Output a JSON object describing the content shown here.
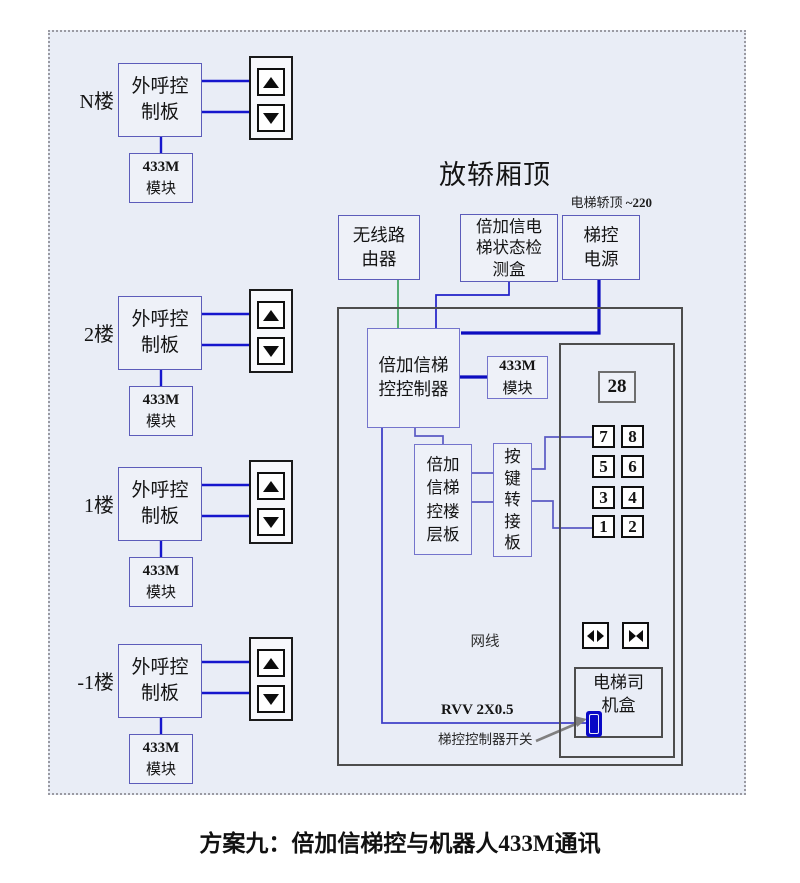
{
  "page": {
    "caption": "方案九：倍加信梯控与机器人433M通讯"
  },
  "colors": {
    "accent_blue": "#1616cd",
    "thick_blue": "#0d0dc0",
    "accent_green": "#3da15e",
    "connector_purple": "#5a5ac4",
    "box_border_purple": "#5c5cba",
    "switch_blue": "#0808c6",
    "frame_bg": "#e9edf6"
  },
  "floors": {
    "board_label": "外呼控制板",
    "module_line1": "433M",
    "module_line2": "模块",
    "items": [
      {
        "label": "N楼"
      },
      {
        "label": "2楼"
      },
      {
        "label": "1楼"
      },
      {
        "label": "-1楼"
      }
    ]
  },
  "car_top": {
    "title": "放轿厢顶",
    "power_note_prefix": "电梯轿顶 ",
    "power_note_value": "~220",
    "router_label": "无线路由器",
    "detector_label": "倍加信电梯状态检测盒",
    "power_label": "梯控电源",
    "controller_label": "倍加信梯控控制器",
    "module_line1": "433M",
    "module_line2": "模块",
    "floor_board_label": "倍加信梯控楼层板",
    "key_adapter_label": "按键转接板",
    "net_cable_label": "网线",
    "rvv_label": "RVV 2X0.5",
    "switch_label": "梯控控制器开关",
    "driver_box_label": "电梯司机盒",
    "cop": {
      "display": "28",
      "buttons": [
        "7",
        "8",
        "5",
        "6",
        "3",
        "4",
        "1",
        "2"
      ]
    }
  }
}
